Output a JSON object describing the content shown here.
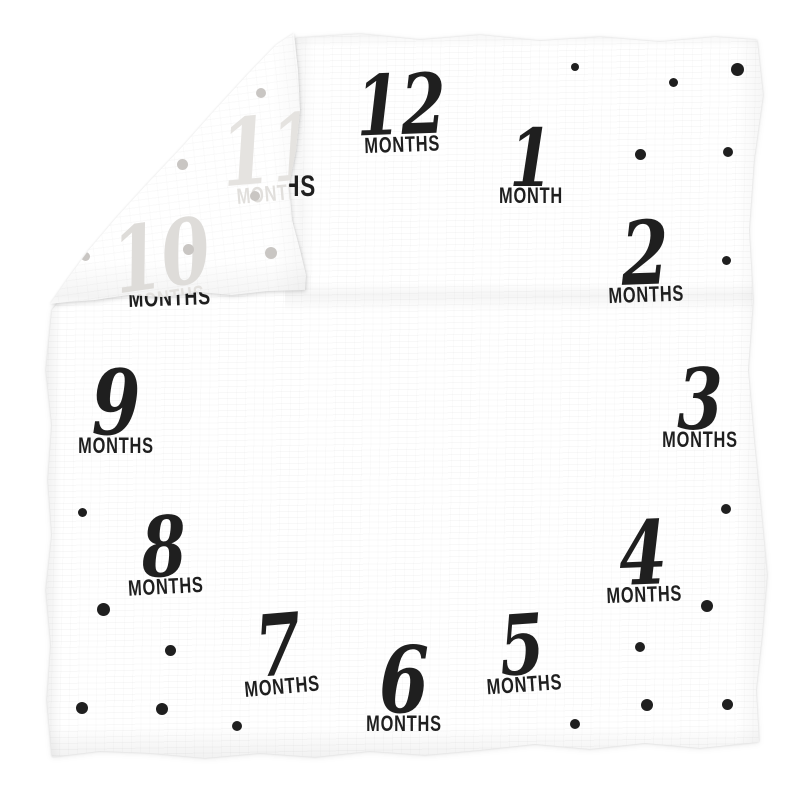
{
  "scene": {
    "background": "#ffffff"
  },
  "blanket": {
    "fabric_color": "#ffffff",
    "ink_color": "#1f1f1f",
    "gray_dot_color": "#c9c6c3",
    "milestones": [
      {
        "id": "12",
        "number": "12",
        "label": "MONTHS",
        "cx": 401,
        "top": 64,
        "rotate": -2,
        "num_size": 83
      },
      {
        "id": "1",
        "number": "1",
        "label": "MONTH",
        "cx": 531,
        "top": 118,
        "rotate": 0,
        "num_size": 80
      },
      {
        "id": "2",
        "number": "2",
        "label": "MONTHS",
        "cx": 645,
        "top": 209,
        "rotate": -2,
        "num_size": 88
      },
      {
        "id": "3",
        "number": "3",
        "label": "MONTHS",
        "cx": 700,
        "top": 358,
        "rotate": 0,
        "num_size": 84
      },
      {
        "id": "4",
        "number": "4",
        "label": "MONTHS",
        "cx": 643,
        "top": 509,
        "rotate": -2,
        "num_size": 88
      },
      {
        "id": "5",
        "number": "5",
        "label": "MONTHS",
        "cx": 522,
        "top": 604,
        "rotate": -4,
        "num_size": 83
      },
      {
        "id": "6",
        "number": "6",
        "label": "MONTHS",
        "cx": 404,
        "top": 634,
        "rotate": 0,
        "num_size": 92
      },
      {
        "id": "7",
        "number": "7",
        "label": "MONTHS",
        "cx": 279,
        "top": 604,
        "rotate": -5,
        "num_size": 85
      },
      {
        "id": "8",
        "number": "8",
        "label": "MONTHS",
        "cx": 164,
        "top": 506,
        "rotate": -3,
        "num_size": 83
      },
      {
        "id": "9",
        "number": "9",
        "label": "MONTHS",
        "cx": 116,
        "top": 358,
        "rotate": 0,
        "num_size": 90
      }
    ],
    "folded_corner": {
      "show_through_milestones": [
        {
          "id": "11",
          "number": "11",
          "label": "MONTHS",
          "cx": 271,
          "top": 104,
          "rotate": -5,
          "num_size": 92,
          "number_color": "#e5e3e0",
          "label_color": "#e1dfdc"
        },
        {
          "id": "10",
          "number": "10",
          "label": "MONTHS",
          "cx": 162,
          "top": 211,
          "rotate": -8,
          "num_size": 90,
          "number_color": "#dedcd9",
          "label_color": "#e3e1de"
        }
      ],
      "gray_dots": [
        [
          261,
          93,
          10
        ],
        [
          182,
          164,
          11
        ],
        [
          255,
          196,
          10
        ],
        [
          188,
          249,
          11
        ],
        [
          271,
          253,
          12
        ],
        [
          85,
          256,
          9
        ]
      ]
    },
    "peek_labels": [
      {
        "id": "11-tail",
        "text": "MONTHS",
        "left": 214,
        "top": 172,
        "font": 30,
        "rotate": 0
      },
      {
        "id": "10",
        "text": "MONTHS",
        "left": 128,
        "top": 288,
        "font": 24,
        "rotate": -2
      }
    ],
    "black_dots": [
      [
        575,
        67,
        8
      ],
      [
        673,
        82,
        9
      ],
      [
        737,
        69,
        13
      ],
      [
        640,
        154,
        11
      ],
      [
        728,
        152,
        10
      ],
      [
        726,
        260,
        9
      ],
      [
        726,
        509,
        10
      ],
      [
        707,
        606,
        12
      ],
      [
        640,
        647,
        10
      ],
      [
        647,
        705,
        12
      ],
      [
        727,
        704,
        11
      ],
      [
        575,
        724,
        10
      ],
      [
        237,
        726,
        10
      ],
      [
        162,
        709,
        12
      ],
      [
        82,
        708,
        12
      ],
      [
        170,
        650,
        11
      ],
      [
        103,
        609,
        13
      ],
      [
        82,
        512,
        9
      ]
    ]
  }
}
